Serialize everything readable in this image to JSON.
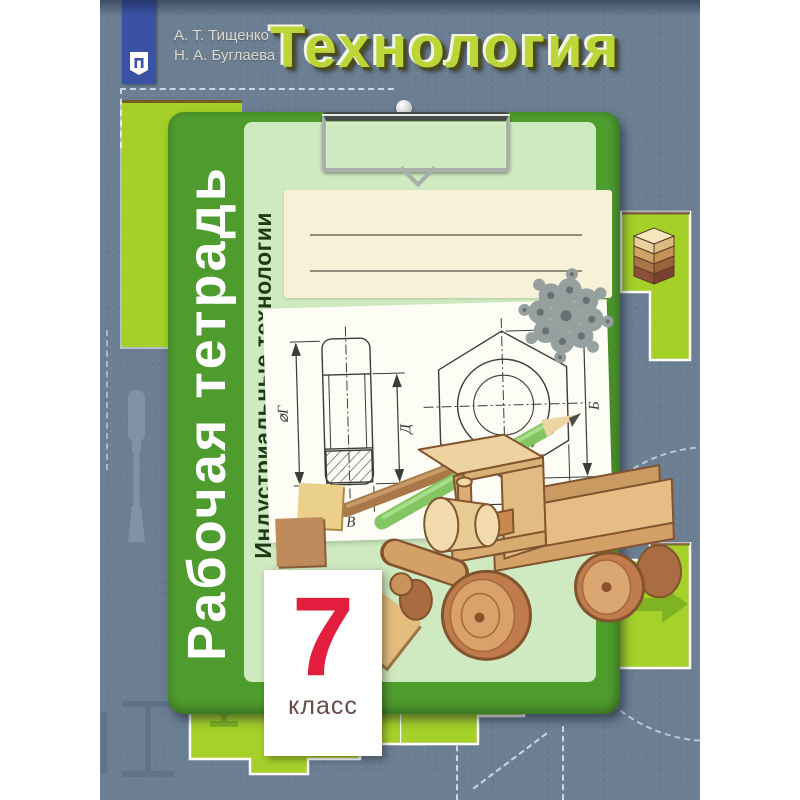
{
  "book": {
    "authors": [
      "А. Т. Тищенко",
      "Н. А. Буглаева"
    ],
    "title": "Технология",
    "series_vertical": "Рабочая тетрадь",
    "subject_vertical": "Индустриальные технологии",
    "grade": {
      "number": "7",
      "label": "класс"
    }
  },
  "technical_drawing": {
    "labels": {
      "side_diameter": "⌀Г",
      "side_height": "Д",
      "side_width": "В",
      "front_width": "А",
      "front_corner": "Б"
    }
  },
  "icons": {
    "publisher_logo": "prosveshchenie-emblem",
    "clip": "clipboard-clip",
    "pencils": "two-pencils",
    "ornament": "metal-filigree-snowflake",
    "truck": "wooden-toy-truck",
    "plywood": "plywood-layer-stack",
    "chisel": "chisel-silhouette"
  },
  "theme": {
    "colors": {
      "bg": "#6b7e92",
      "blue": "#3a52a3",
      "green": "#4f9c2e",
      "lightgreen": "#cfe9c0",
      "chartreuse": "#a5d028",
      "title": "#bcd537",
      "red": "#e21d3e",
      "cream": "#f7f1d8",
      "paper": "#fdfdf6"
    }
  }
}
